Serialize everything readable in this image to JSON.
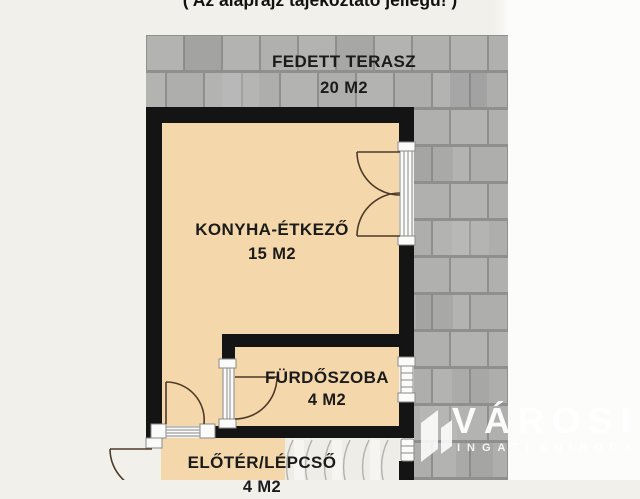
{
  "note": "( Az alaprajz tájékoztató jellegű! )",
  "rooms": {
    "terrace": {
      "name": "FEDETT TERASZ",
      "area": "20 M2"
    },
    "kitchen": {
      "name": "KONYHA-ÉTKEZŐ",
      "area": "15 M2"
    },
    "bathroom": {
      "name": "FÜRDŐSZOBA",
      "area": "4 M2"
    },
    "hall": {
      "name": "ELŐTÉR/LÉPCSŐ",
      "area": "4 M2"
    }
  },
  "watermark": {
    "brand": "VÁROSI",
    "subtitle": "INGATLANIRODA"
  },
  "colors": {
    "background": "#f2f0ea",
    "room_fill": "#f4d7aa",
    "wall": "#141414",
    "tile": "#b3b3b2",
    "grout": "#8f8f8e",
    "stairs": "#efede8",
    "door_arc": "#4e3a2a",
    "watermark": "#ffffff"
  }
}
